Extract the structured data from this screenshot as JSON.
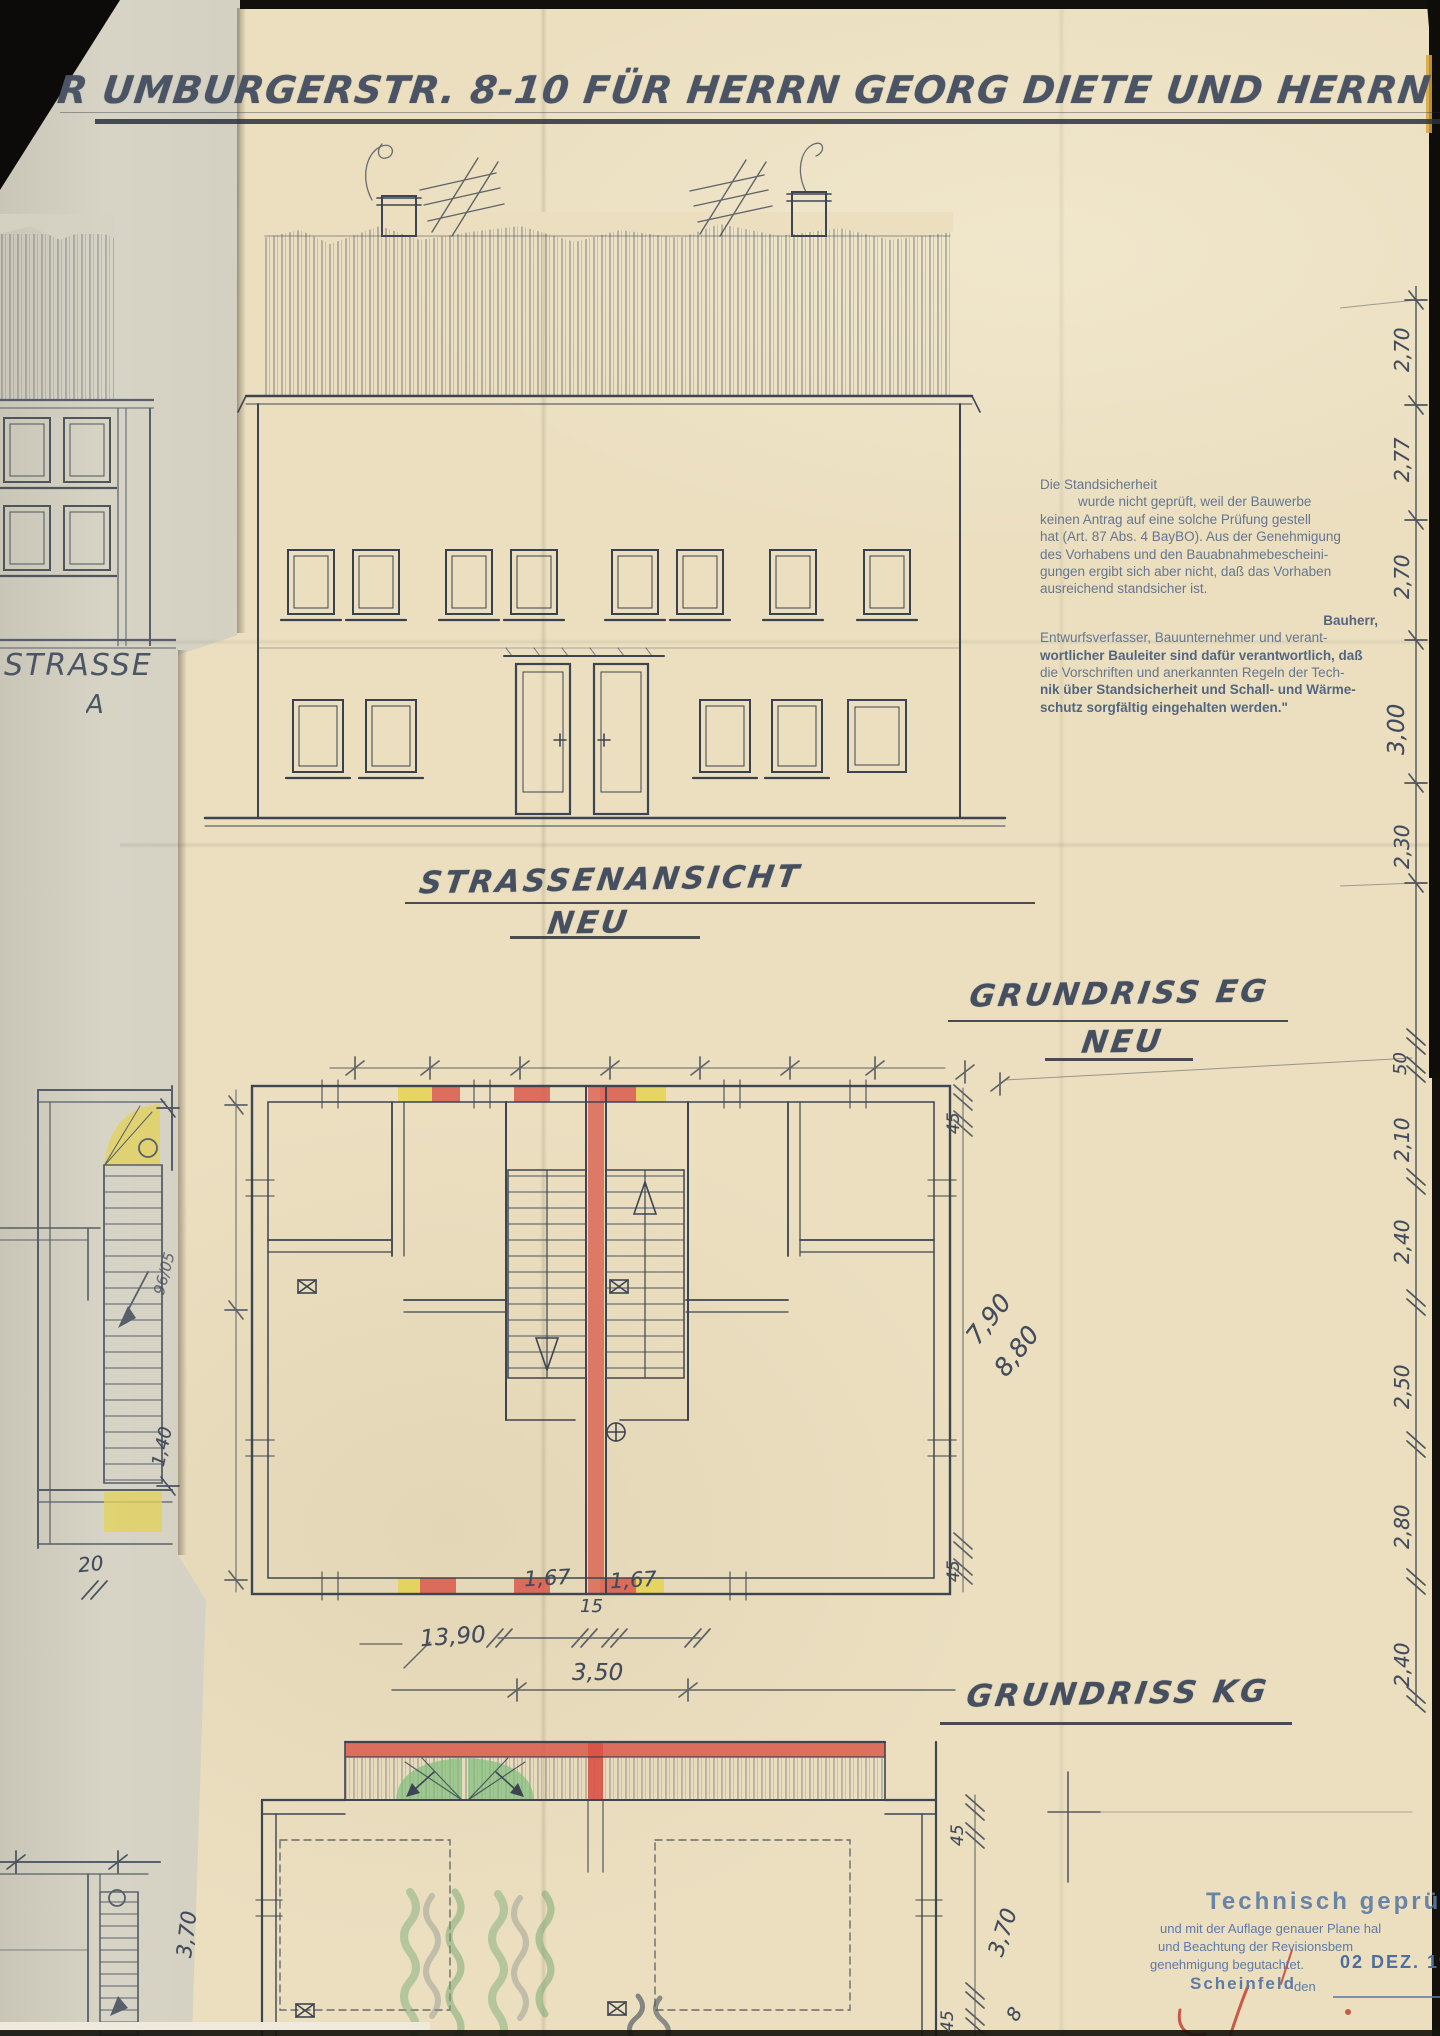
{
  "title": {
    "text": "R UMBURGERSTR. 8-10 FÜR HERRN GEORG DIETE UND HERRN G"
  },
  "labels": {
    "street_view": "STRASSENANSICHT",
    "street_view_sub": "NEU",
    "plan_eg": "GRUNDRISS EG",
    "plan_eg_sub": "NEU",
    "plan_kg": "GRUNDRISS KG",
    "strasse_partial": "STRASSE",
    "strasse_partial_sub": "A"
  },
  "notice": {
    "l1": "Die Standsicherheit",
    "l2": "wurde  nicht  geprüft,  weil  der  Bauwerbe",
    "l3": "keinen Antrag auf eine solche Prüfung gestell",
    "l4": "hat (Art. 87 Abs. 4 BayBO). Aus der Genehmigung",
    "l5": "des Vorhabens und den Bauabnahmebescheini-",
    "l6": "gungen ergibt sich aber nicht, daß das Vorhaben",
    "l7": "ausreichend standsicher ist.",
    "l8": "Bauherr,",
    "l9": "Entwurfsverfasser, Bauunternehmer und verant-",
    "l10": "wortlicher Bauleiter sind dafür verantwortlich, daß",
    "l11": "die Vorschriften und anerkannten Regeln der Tech-",
    "l12": "nik über Standsicherheit und Schall- und Wärme-",
    "l13": "schutz sorgfältig eingehalten werden.\""
  },
  "stamp": {
    "title": "Technisch geprüft:",
    "l1": "und mit der Auflage genauer Plane hal",
    "l2": "und Beachtung der Revisionsbem",
    "l3": "genehmigung begutachtet.",
    "date": "02 DEZ. 19",
    "city": "Scheinfeld",
    "den_label": "den"
  },
  "dimensions": {
    "right_chain": [
      "2,70",
      "2,77",
      "2,70",
      "3,00",
      "2,30",
      "50",
      "2,10",
      "2,40",
      "2,50",
      "2,80",
      "2,40"
    ],
    "eg_seg1": "1,67",
    "eg_seg_mid": "15",
    "eg_seg2": "1,67",
    "eg_total": "13,90",
    "eg_center": "3,50",
    "eg_depth1": "7,90",
    "eg_depth2": "8,80",
    "eg_wall_top": "45",
    "eg_wall_bottom": "45",
    "kg_wall_top": "45",
    "kg_depth": "3,70",
    "kg_wall_bottom": "45",
    "kg_partial": "8",
    "left_depth": "3,70",
    "left_a": "96/05",
    "left_b": "1,40",
    "left_c": "20"
  },
  "colors": {
    "highlight_red": "#d95245",
    "highlight_yellow": "#e6d34b",
    "highlight_green": "#7fbf7d",
    "pencil": "#3d4552",
    "paper_main": "#ebdfc0",
    "paper_under": "#d6d3c5",
    "stamp_blue": "#5d7ba6"
  }
}
